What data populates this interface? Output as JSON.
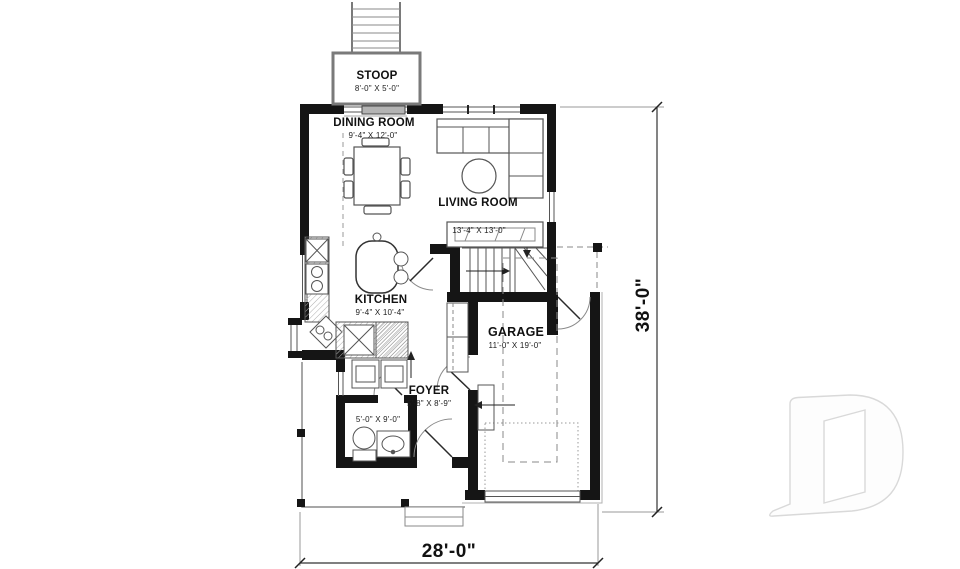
{
  "rooms": [
    {
      "id": "stoop",
      "name": "STOOP",
      "dims": "8'-0\" X 5'-0\""
    },
    {
      "id": "dining",
      "name": "DINING ROOM",
      "dims": "9'-4\" X 12'-0\""
    },
    {
      "id": "living",
      "name": "LIVING ROOM",
      "dims": "13'-4\" X 13'-0\""
    },
    {
      "id": "kitchen",
      "name": "KITCHEN",
      "dims": "9'-4\" X 10'-4\""
    },
    {
      "id": "garage",
      "name": "GARAGE",
      "dims": "11'-0\" X 19'-0\""
    },
    {
      "id": "foyer",
      "name": "FOYER",
      "dims": "5'-8\" X 8'-9\""
    },
    {
      "id": "powder",
      "name": "",
      "dims": "5'-0\" X 9'-0\""
    }
  ],
  "dimensions": {
    "overall_width": "28'-0\"",
    "overall_depth": "38'-0\""
  },
  "colors": {
    "wall": "#151515",
    "line": "#555555",
    "light_line": "#999999",
    "logo_outline": "#d9d9d9",
    "background": "#ffffff"
  }
}
